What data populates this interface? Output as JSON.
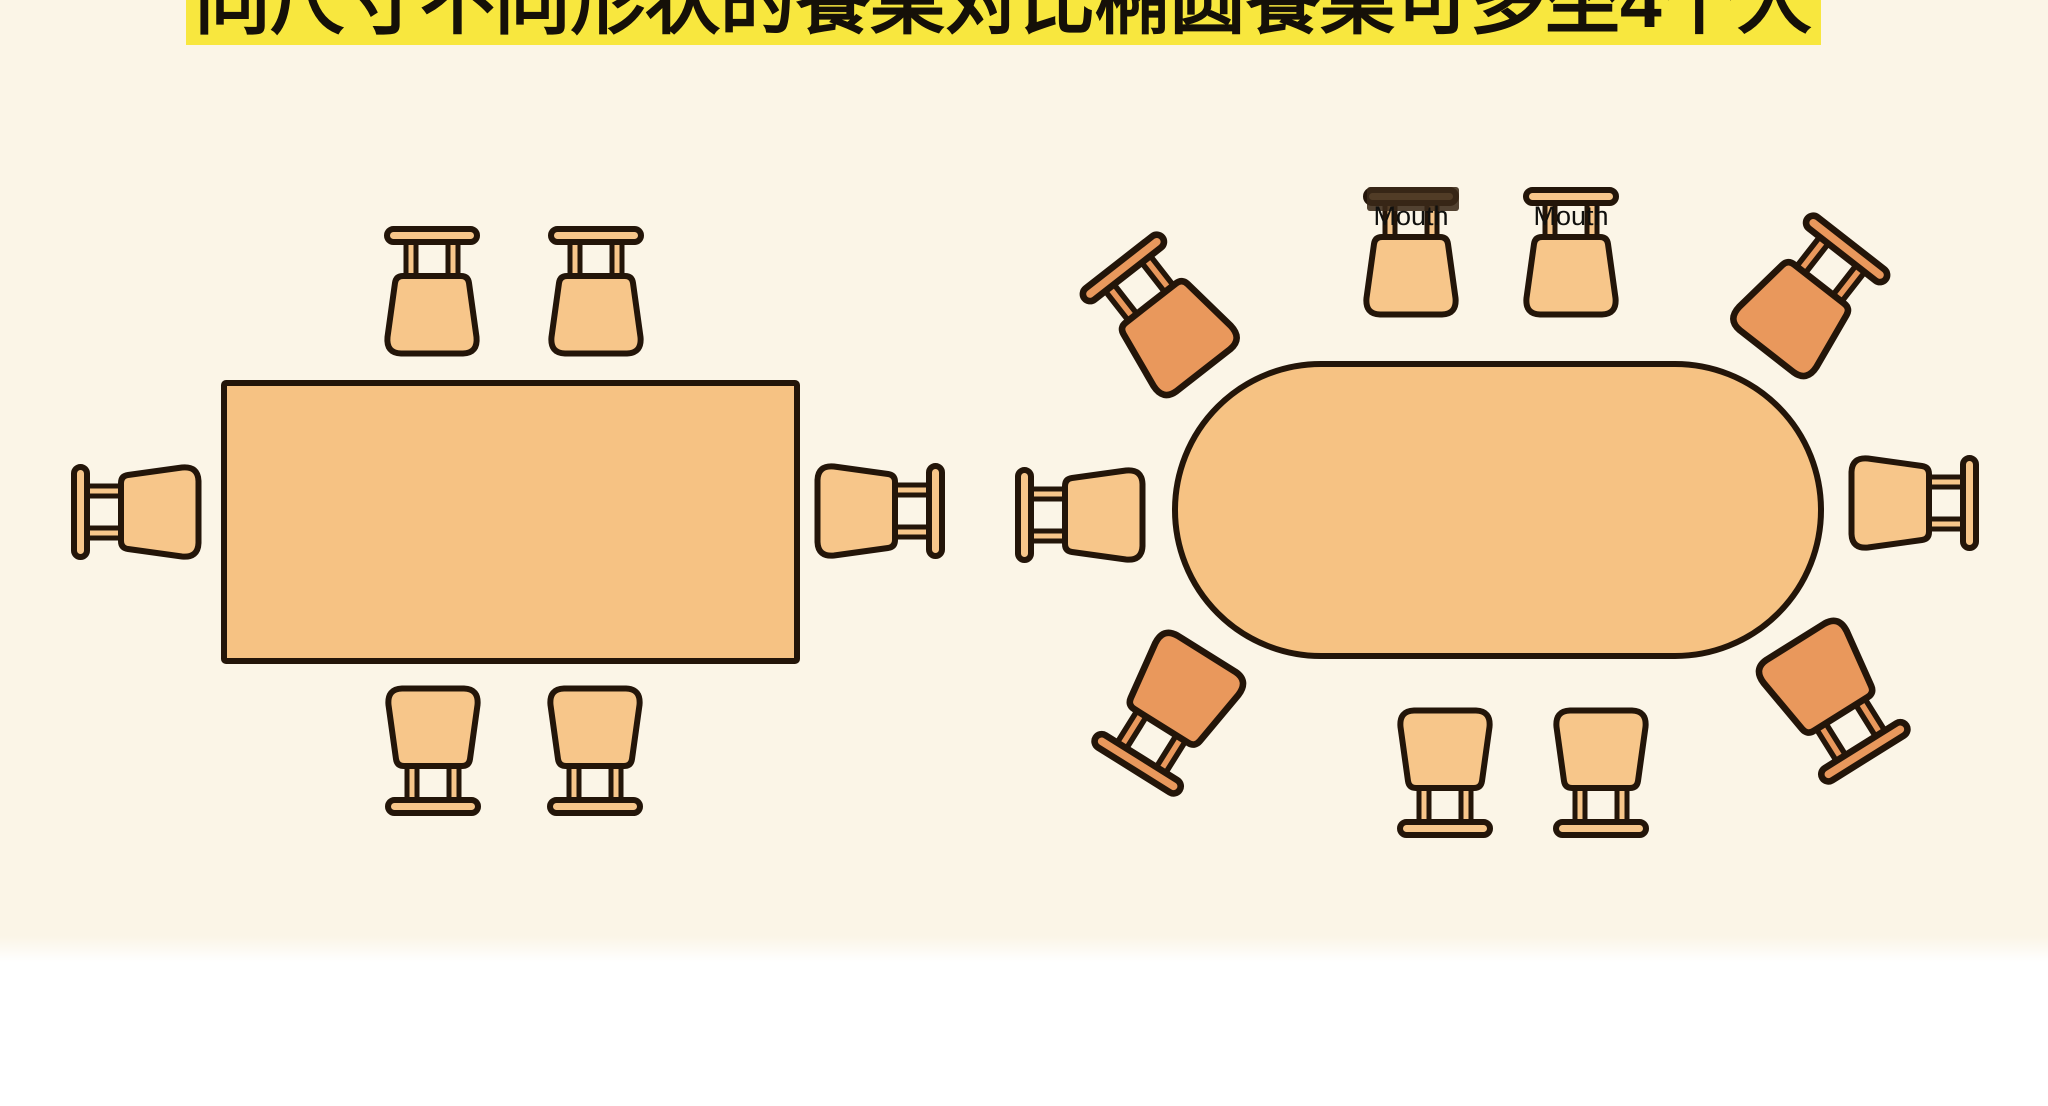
{
  "title": {
    "text": "同尺寸不同形状的餐桌对比椭圆餐桌可多坐4个人"
  },
  "labels": {
    "mouth_1": "Mouth",
    "mouth_2": "Mouth"
  },
  "colors": {
    "background": "#FBF5E7",
    "footer_background": "#FFFFFF",
    "title_highlight": "#F8E73E",
    "title_text": "#151008",
    "table_fill": "#F6C283",
    "chair_fill": "#F7C68A",
    "chair_accent_fill": "#E9985C",
    "outline": "#231509"
  },
  "diagram": {
    "left_table": {
      "shape": "rectangle",
      "seat_count": 6
    },
    "right_table": {
      "shape": "oval",
      "seat_count": 10,
      "accent_corner_chairs": 4
    }
  }
}
